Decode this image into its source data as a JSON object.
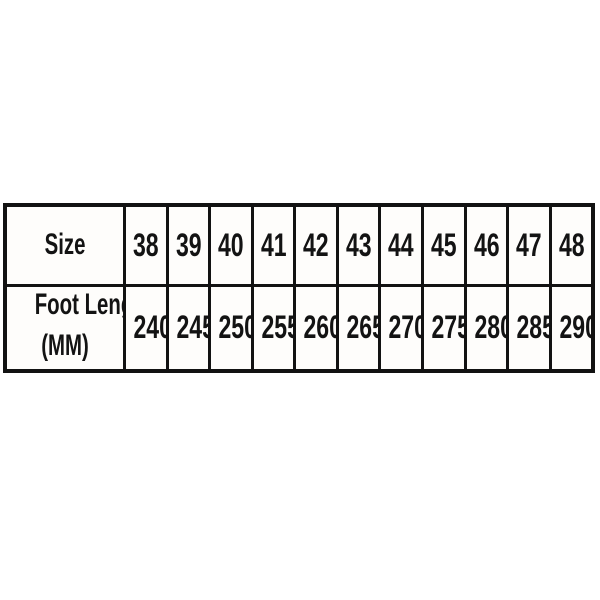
{
  "table": {
    "size_label": "Size",
    "foot_length_label_line1": "Foot Length",
    "foot_length_label_line2": "(MM)",
    "sizes": [
      "38",
      "39",
      "40",
      "41",
      "42",
      "43",
      "44",
      "45",
      "46",
      "47",
      "48"
    ],
    "foot_lengths": [
      "240",
      "245",
      "250",
      "255",
      "260",
      "265",
      "270",
      "275",
      "280",
      "285",
      "290"
    ]
  },
  "colors": {
    "border": "#121212",
    "text": "#131313",
    "background": "#ffffff",
    "cell_background": "#fefdfb"
  },
  "chart_data": {
    "type": "table",
    "title": "Shoe size chart",
    "columns": [
      "Size",
      "38",
      "39",
      "40",
      "41",
      "42",
      "43",
      "44",
      "45",
      "46",
      "47",
      "48"
    ],
    "rows": [
      {
        "label": "Size",
        "values": [
          38,
          39,
          40,
          41,
          42,
          43,
          44,
          45,
          46,
          47,
          48
        ]
      },
      {
        "label": "Foot Length (MM)",
        "values": [
          240,
          245,
          250,
          255,
          260,
          265,
          270,
          275,
          280,
          285,
          290
        ]
      }
    ]
  }
}
